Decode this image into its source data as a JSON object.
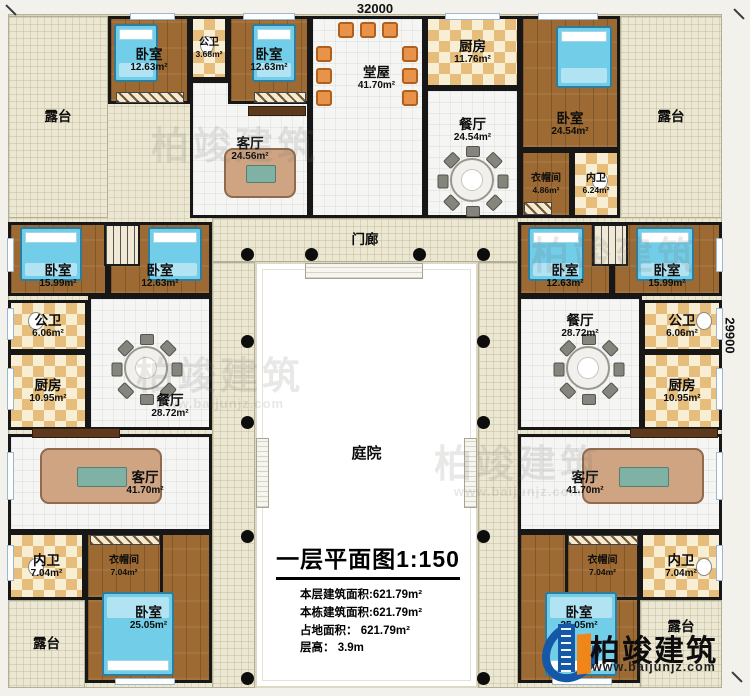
{
  "dimensions": {
    "top": "32000",
    "right": "29900"
  },
  "rooms": {
    "terrace_tl": {
      "name": "露台"
    },
    "bedroom_a": {
      "name": "卧室",
      "area": "12.63m²"
    },
    "pubbath_a": {
      "name": "公卫",
      "area": "3.68m²"
    },
    "bedroom_b": {
      "name": "卧室",
      "area": "12.63m²"
    },
    "living_top": {
      "name": "客厅",
      "area": "24.56m²"
    },
    "tangwu": {
      "name": "堂屋",
      "area": "41.70m²"
    },
    "kitchen_top": {
      "name": "厨房",
      "area": "11.76m²"
    },
    "dining_top": {
      "name": "餐厅",
      "area": "24.54m²"
    },
    "bedroom_c": {
      "name": "卧室",
      "area": "24.54m²"
    },
    "cloak_tr": {
      "name": "衣帽间",
      "area": "4.86m²"
    },
    "innerbath_tr": {
      "name": "内卫",
      "area": "6.24m²"
    },
    "terrace_tr": {
      "name": "露台"
    },
    "bedroom_d": {
      "name": "卧室",
      "area": "15.99m²"
    },
    "bedroom_e": {
      "name": "卧室",
      "area": "12.63m²"
    },
    "pubbath_l": {
      "name": "公卫",
      "area": "6.06m²"
    },
    "kitchen_l": {
      "name": "厨房",
      "area": "10.95m²"
    },
    "dining_l": {
      "name": "餐厅",
      "area": "28.72m²"
    },
    "living_l": {
      "name": "客厅",
      "area": "41.70m²"
    },
    "innerbath_bl": {
      "name": "内卫",
      "area": "7.04m²"
    },
    "cloak_bl": {
      "name": "衣帽间",
      "area": "7.04m²"
    },
    "bedroom_f": {
      "name": "卧室",
      "area": "25.05m²"
    },
    "terrace_bl": {
      "name": "露台"
    },
    "bedroom_g": {
      "name": "卧室",
      "area": "12.63m²"
    },
    "bedroom_h": {
      "name": "卧室",
      "area": "15.99m²"
    },
    "dining_r": {
      "name": "餐厅",
      "area": "28.72m²"
    },
    "pubbath_r": {
      "name": "公卫",
      "area": "6.06m²"
    },
    "kitchen_r": {
      "name": "厨房",
      "area": "10.95m²"
    },
    "living_r": {
      "name": "客厅",
      "area": "41.70m²"
    },
    "bedroom_i": {
      "name": "卧室",
      "area": "25.05m²"
    },
    "cloak_br": {
      "name": "衣帽间",
      "area": "7.04m²"
    },
    "innerbath_br": {
      "name": "内卫",
      "area": "7.04m²"
    },
    "terrace_br": {
      "name": "露台"
    },
    "porch": {
      "name": "门廊"
    },
    "courtyard": {
      "name": "庭院"
    }
  },
  "title_block": {
    "title": "一层平面图",
    "scale": "1:150",
    "lines": [
      "本层建筑面积:621.79m²",
      "本栋建筑面积:621.79m²",
      "占地面积： 621.79m²",
      "层高： 3.9m"
    ]
  },
  "logo": {
    "brand": "柏竣建筑",
    "url": "www.baijunjz.com"
  },
  "watermark": {
    "text": "柏竣建筑",
    "url": "www.baijunjz.com"
  },
  "colors": {
    "wall": "#171717",
    "wood_floor": "#9c6a32",
    "checker_tan": "#e7bd7c",
    "terrace": "#ebe7d3",
    "bed_blue": "#72cde9",
    "chair_orange": "#e8934a",
    "logo_blue": "#1558a8",
    "logo_orange": "#f08519"
  }
}
